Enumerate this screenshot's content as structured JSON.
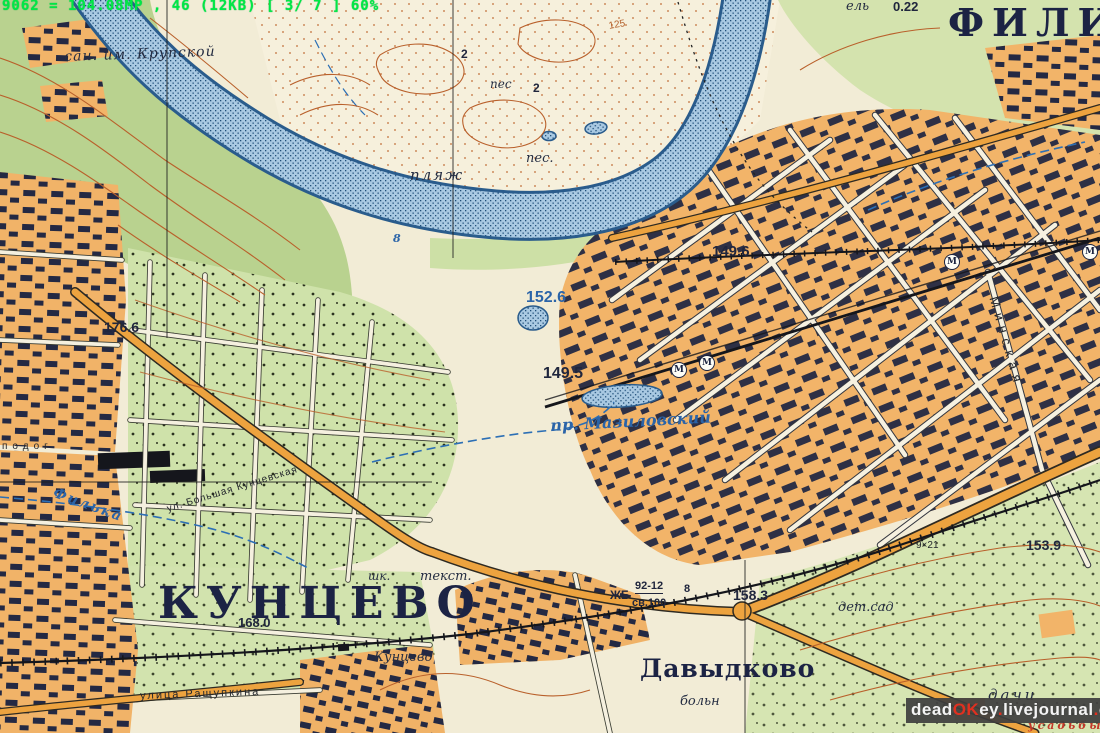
{
  "overlay": {
    "scanner_status": "9062 = 104.08MP , 46 (12KB) [ 3/ 7 ]  60%",
    "watermark": {
      "p1": "dead",
      "p2": "OK",
      "p3": "ey",
      "d1": ".",
      "p4": "livejournal",
      "d2": ".",
      "p5": "com"
    }
  },
  "colors": {
    "paper": "#f2ecd6",
    "urban_block": "#f2b469",
    "garden_green": "#cfe2aa",
    "forest_green": "#b9d28f",
    "water_fill": "#a9c9e2",
    "water_line": "#2a5c8c",
    "contour_brown": "#b5622d",
    "building_dark": "#242943",
    "highway_orange": "#eda33f",
    "label_navy": "#1c2344",
    "hydro_blue": "#2b64a8",
    "note_red": "#c2382a",
    "scan_green": "#00e845",
    "watermark_red": "#e03020"
  },
  "metro": {
    "symbol": "М",
    "points": [
      [
        678,
        369
      ],
      [
        706,
        362
      ],
      [
        951,
        261
      ],
      [
        1089,
        251
      ]
    ]
  },
  "labels": [
    {
      "id": "fili",
      "t": "ФИЛИ",
      "x": 948,
      "y": 4,
      "st": "place-xl",
      "s": 38,
      "ls": 8
    },
    {
      "id": "kuntsevo",
      "t": "КУНЦЕВО",
      "x": 158,
      "y": 582,
      "st": "place-xl",
      "s": 44,
      "ls": 8
    },
    {
      "id": "davydkovo",
      "t": "Давыдково",
      "x": 640,
      "y": 656,
      "st": "place-lg",
      "s": 25,
      "ls": 1
    },
    {
      "id": "san-krupskoy",
      "t": "сан. им. Крупской",
      "x": 64,
      "y": 50,
      "st": "note",
      "s": 14,
      "ls": 1,
      "rot": -2
    },
    {
      "id": "plyazh",
      "t": "пляж",
      "x": 410,
      "y": 168,
      "st": "note",
      "s": 15,
      "ls": 2
    },
    {
      "id": "pes-1",
      "t": "пес",
      "x": 490,
      "y": 78,
      "st": "note",
      "s": 12
    },
    {
      "id": "pes-2",
      "t": "пес.",
      "x": 526,
      "y": 152,
      "st": "note",
      "s": 13
    },
    {
      "id": "el-spruce",
      "t": "ель",
      "x": 846,
      "y": 0,
      "st": "note",
      "s": 13
    },
    {
      "id": "h022",
      "t": "0.22",
      "x": 893,
      "y": 0,
      "st": "elev",
      "s": 13
    },
    {
      "id": "h176",
      "t": "176.6",
      "x": 104,
      "y": 320,
      "st": "elev",
      "s": 14
    },
    {
      "id": "h152",
      "t": "152.6",
      "x": 526,
      "y": 290,
      "st": "elev-blue",
      "s": 16
    },
    {
      "id": "h149a",
      "t": "149.5",
      "x": 543,
      "y": 366,
      "st": "elev",
      "s": 16
    },
    {
      "id": "h149b",
      "t": "149.6",
      "x": 712,
      "y": 244,
      "st": "elev",
      "s": 15
    },
    {
      "id": "h168",
      "t": "168.0",
      "x": 238,
      "y": 616,
      "st": "elev",
      "s": 13
    },
    {
      "id": "h158",
      "t": "158.3",
      "x": 733,
      "y": 588,
      "st": "elev",
      "s": 14
    },
    {
      "id": "h153",
      "t": "153.9",
      "x": 1026,
      "y": 538,
      "st": "elev",
      "s": 14
    },
    {
      "id": "mazilovsky-pond",
      "t": "пр. Мазиловский",
      "x": 550,
      "y": 418,
      "st": "hydro",
      "s": 16,
      "rot": -3
    },
    {
      "id": "filka-river",
      "t": "Филька",
      "x": 56,
      "y": 486,
      "st": "hydro",
      "s": 14,
      "rot": 20,
      "ls": 2
    },
    {
      "id": "bolshaya-kuntsevskaya",
      "t": "ул. Большая Кунцевская",
      "x": 166,
      "y": 505,
      "st": "street",
      "s": 10,
      "ls": 1,
      "rot": -17
    },
    {
      "id": "rashchupkina",
      "t": "улица Ращупкина",
      "x": 140,
      "y": 691,
      "st": "street",
      "s": 11,
      "ls": 2,
      "rot": -2
    },
    {
      "id": "kuntsevo-station",
      "t": "Кунцево",
      "x": 374,
      "y": 651,
      "st": "note",
      "s": 13
    },
    {
      "id": "shk",
      "t": "шк.",
      "x": 368,
      "y": 570,
      "st": "note",
      "s": 12
    },
    {
      "id": "tekst",
      "t": "текст.",
      "x": 420,
      "y": 570,
      "st": "note",
      "s": 13
    },
    {
      "id": "zhb",
      "t": "ЖБ",
      "x": 610,
      "y": 589,
      "st": "elev",
      "s": 12
    },
    {
      "id": "bridge-92-12",
      "t": "92-12",
      "x": 635,
      "y": 581,
      "st": "elev-u",
      "s": 11
    },
    {
      "id": "bridge-8",
      "t": "8",
      "x": 684,
      "y": 584,
      "st": "elev",
      "s": 11
    },
    {
      "id": "sv100",
      "t": "св.100",
      "x": 632,
      "y": 598,
      "st": "elev",
      "s": 11
    },
    {
      "id": "detsad",
      "t": "дет.сад",
      "x": 838,
      "y": 601,
      "st": "note",
      "s": 13
    },
    {
      "id": "boln",
      "t": "больн",
      "x": 680,
      "y": 695,
      "st": "note",
      "s": 13
    },
    {
      "id": "dachi",
      "t": "дачи",
      "x": 988,
      "y": 688,
      "st": "note",
      "s": 15,
      "ls": 3
    },
    {
      "id": "usadby",
      "t": "усадьбы",
      "x": 1028,
      "y": 720,
      "st": "red-note",
      "s": 11,
      "ls": 3
    },
    {
      "id": "minskaya",
      "t": "Минская",
      "x": 1000,
      "y": 295,
      "st": "street",
      "s": 13,
      "ls": 6,
      "rot": 74
    },
    {
      "id": "road-9x21",
      "t": "9×21",
      "x": 916,
      "y": 541,
      "st": "street",
      "s": 10
    },
    {
      "id": "podog",
      "t": "подог",
      "x": 2,
      "y": 442,
      "st": "street",
      "s": 10,
      "ls": 5
    },
    {
      "id": "contour-125",
      "t": "125",
      "x": 608,
      "y": 22,
      "st": "contour-num",
      "s": 10,
      "rot": -10
    },
    {
      "id": "n2a",
      "t": "2",
      "x": 461,
      "y": 48,
      "st": "elev",
      "s": 12
    },
    {
      "id": "n2b",
      "t": "2",
      "x": 533,
      "y": 82,
      "st": "elev",
      "s": 12
    },
    {
      "id": "depth-8",
      "t": "8",
      "x": 393,
      "y": 233,
      "st": "hydro",
      "s": 11
    }
  ]
}
